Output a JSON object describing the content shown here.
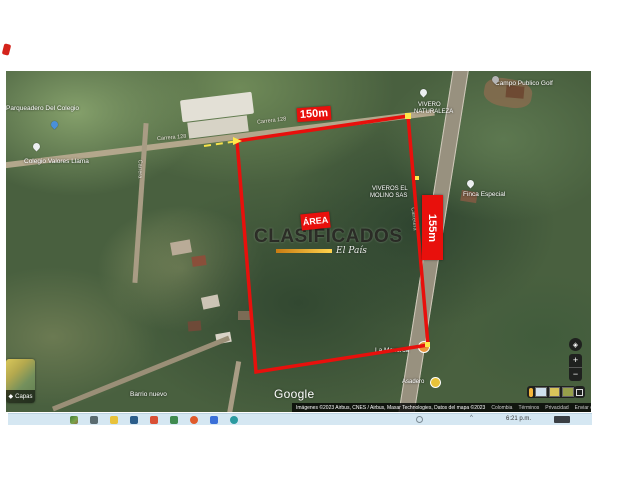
{
  "parcel": {
    "top_length": "150m",
    "side_length": "155m",
    "area_label": "ÁREA"
  },
  "watermark": {
    "title": "CLASIFICADOS",
    "brand": "El País"
  },
  "map": {
    "place_labels": [
      {
        "text": "Parqueadero Del Colegio"
      },
      {
        "text": "Colegio Valores Llama"
      },
      {
        "text": "Campo Publico Golf"
      },
      {
        "text": "VIVERO"
      },
      {
        "text": "NATURALEZA"
      },
      {
        "text": "VIVEROS EL"
      },
      {
        "text": "MOLINO SAS"
      },
      {
        "text": "Finca Especial"
      },
      {
        "text": "La Mazorca"
      },
      {
        "text": "Asadero"
      },
      {
        "text": "Barrio nuevo"
      }
    ],
    "road_labels": [
      {
        "text": "Carrera 128"
      },
      {
        "text": "Carrera 128"
      },
      {
        "text": "Carrera"
      },
      {
        "text": "Carretera"
      }
    ]
  },
  "gmaps_ui": {
    "logo": "Google",
    "layers_label": "Capas",
    "zoom_in": "+",
    "zoom_out": "−",
    "attribution": "Imágenes ©2023 Airbus, CNES / Airbus, Maxar Technologies, Datos del mapa ©2023",
    "links": [
      "Colombia",
      "Términos",
      "Privacidad",
      "Enviar comentarios"
    ],
    "scale_label": "20 m"
  },
  "taskbar": {
    "time": "6:21 p.m."
  }
}
